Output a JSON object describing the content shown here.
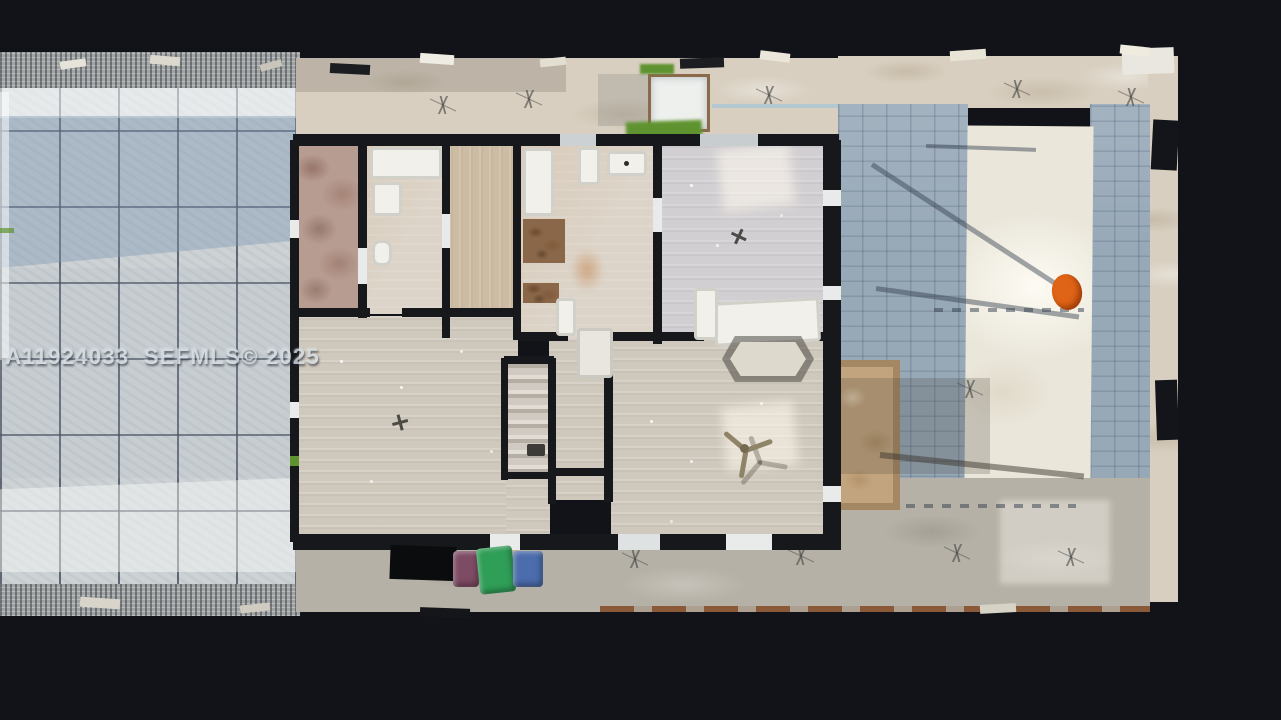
{
  "watermark": {
    "text": "A11924033  SEFMLS© 2025"
  },
  "colors": {
    "bg": "#121318",
    "paver": "#cdd2d5",
    "paver-grout": "#46525e",
    "shade-blue": "#7e97b2",
    "gravel": "#9fa3a4",
    "walkway-tan": "#d8cfc0",
    "patio-blue": "#97a8b7",
    "slab-white": "#eae6da",
    "concrete-gray": "#b6b1a6",
    "floor-wood": "#cfc8bc",
    "floor-cool": "#d2cfd2",
    "floor-warm": "#cdbca4",
    "terrazzo": "#b79c92",
    "wall": "#17181b",
    "fixture-white": "#f1f0ea",
    "shelf-brown": "#8a6748",
    "grass": "#5f9330",
    "marker-orange": "#e06417",
    "bin-maroon": "#7e4b64",
    "bin-green": "#2f9e57",
    "bin-blue": "#4b6dac",
    "planter-tan": "#c2a47e",
    "rust": "#8a5a38",
    "watermark-gray": "#d5dce3"
  },
  "objects": {
    "scene": "aerial-top-down-house-scan",
    "left-area": "paver-patio",
    "right-area": "concrete-patio",
    "bins": [
      "shadow",
      "maroon-bin",
      "green-bin",
      "blue-bin"
    ],
    "marker": "orange-marker"
  }
}
